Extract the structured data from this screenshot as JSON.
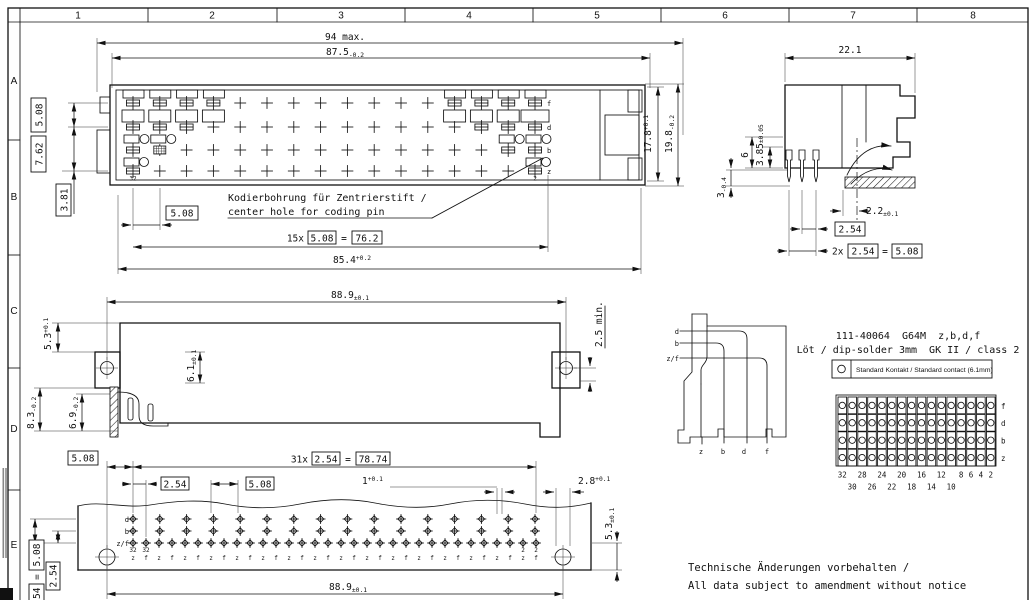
{
  "sheet": {
    "border_columns": [
      "1",
      "2",
      "3",
      "4",
      "5",
      "6",
      "7",
      "8"
    ],
    "border_rows": [
      "A",
      "B",
      "C",
      "D",
      "E"
    ]
  },
  "top_view": {
    "dim_overall": "94 max.",
    "dim_body": {
      "v": "87.5",
      "tol": "-0.2"
    },
    "dim_height_inner": {
      "v": "17.8",
      "tol": "+0.1"
    },
    "dim_height_outer": {
      "v": "19.8",
      "tol": "-0.2"
    },
    "box_row_pitch": "5.08",
    "box_row_span": "7.62",
    "box_row_offset": "3.81",
    "box_col_pitch": "5.08",
    "pitch_eq": {
      "prefix": "15x",
      "pitch": "5.08",
      "eq": "=",
      "total": "76.2"
    },
    "dim_pin_span": {
      "v": "85.4",
      "tol": "+0.2"
    },
    "pin_first": "32",
    "pin_last": "2",
    "row_labels": [
      "f",
      "d",
      "b",
      "z"
    ],
    "note_line1": "Kodierbohrung für Zentrierstift /",
    "note_line2": "center hole for coding pin"
  },
  "side_view": {
    "dim_depth": "22.1",
    "dim_standoff": {
      "v": "3.85",
      "tol": "±0.05"
    },
    "dim_six": "6",
    "dim_pin_len": {
      "v": "3",
      "tol": "-0.4"
    },
    "dim_tail": {
      "v": "2.2",
      "tol": "±0.1"
    },
    "box_pitch": "2.54",
    "pitch_eq": {
      "prefix": "2x",
      "pitch": "2.54",
      "eq": "=",
      "total": "5.08"
    }
  },
  "front_view": {
    "dim_hole_span": {
      "v": "88.9",
      "tol": "±0.1"
    },
    "dim_flange_top": {
      "v": "5.3",
      "tol": "+0.1"
    },
    "dim_body_h": {
      "v": "6.1",
      "tol": "±0.1"
    },
    "dim_depth_lower": {
      "v": "8.3",
      "tol": "-0.2"
    },
    "dim_depth_upper": {
      "v": "6.9",
      "tol": "-0.2"
    },
    "dim_clearance": "2.5 min."
  },
  "bottom_view": {
    "box_edge_pitch": "5.08",
    "pitch_eq": {
      "prefix": "31x",
      "pitch": "2.54",
      "eq": "=",
      "total": "78.74"
    },
    "box_pitch_small": "2.54",
    "box_pitch_large": "5.08",
    "dim_pin_w": {
      "v": "1",
      "tol": "+0.1"
    },
    "dim_hole_edge": {
      "v": "2.8",
      "tol": "+0.1"
    },
    "dim_row_edge": {
      "v": "5.3",
      "tol": "±0.1"
    },
    "dim_hole_span": {
      "v": "88.9",
      "tol": "±0.1"
    },
    "left_pitch_eq": {
      "pitch": "2.54",
      "eq": "=",
      "total": "5.08"
    },
    "box_left_small": "2.54",
    "row_labels": [
      "d",
      "b",
      "z/f"
    ],
    "first_pin_no": "32",
    "last_pin_no": "2",
    "zf_labels": [
      "z",
      "f"
    ]
  },
  "schematic": {
    "left_labels": [
      "d",
      "b",
      "z/f"
    ],
    "bottom_labels": [
      "z",
      "b",
      "d",
      "f"
    ]
  },
  "part_info": {
    "line1": "111-40064  G64M  z,b,d,f",
    "line2": "Löt / dip-solder 3mm  GK II / class 2"
  },
  "legend": {
    "symbol": "○",
    "label": "Standard Kontakt / Standard contact (6.1mm)"
  },
  "contact_grid": {
    "row_labels": [
      "f",
      "d",
      "b",
      "z"
    ],
    "columns": 16,
    "numbers_upper": [
      "32",
      "28",
      "24",
      "20",
      "16",
      "12",
      "8",
      "6",
      "4",
      "2"
    ],
    "numbers_lower": [
      "30",
      "26",
      "22",
      "18",
      "14",
      "10"
    ]
  },
  "footer": {
    "line1": "Technische Änderungen vorbehalten /",
    "line2": "All data subject to amendment without notice"
  }
}
